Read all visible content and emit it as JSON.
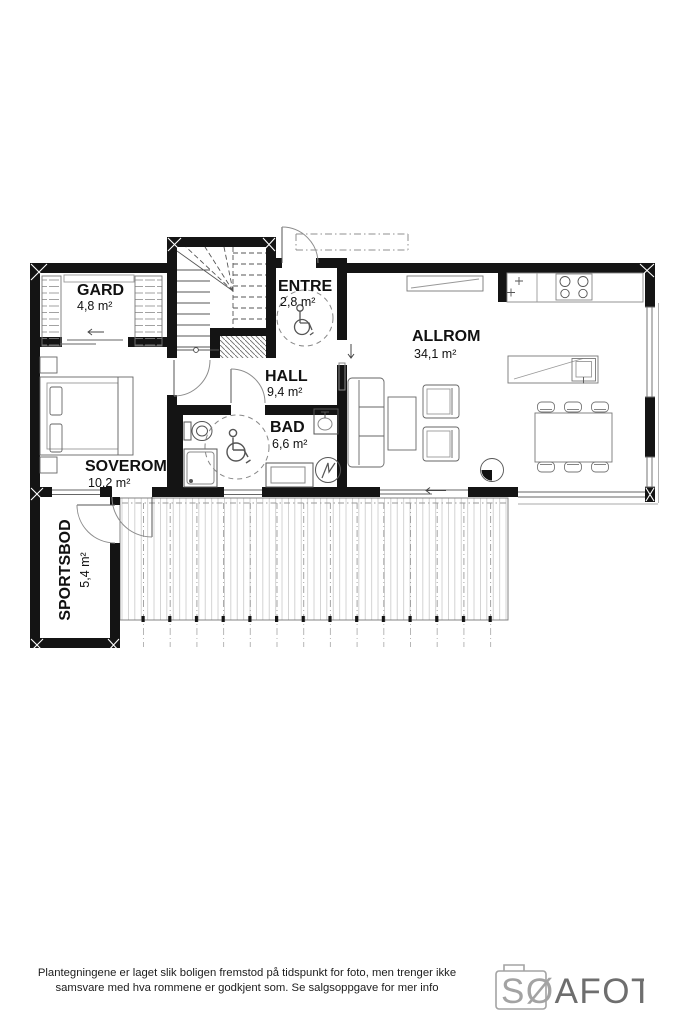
{
  "plan": {
    "title": "floor-plan-first-floor",
    "rooms": {
      "gard": {
        "name": "GARD",
        "area": "4,8 m²"
      },
      "entre": {
        "name": "ENTRE",
        "area": "2,8 m²"
      },
      "allrom": {
        "name": "ALLROM",
        "area": "34,1 m²"
      },
      "hall": {
        "name": "HALL",
        "area": "9,4 m²"
      },
      "bad": {
        "name": "BAD",
        "area": "6,6 m²"
      },
      "soverom": {
        "name": "SOVEROM",
        "area": "10,2 m²"
      },
      "sportsbod": {
        "name": "SPORTSBOD",
        "area": "5,4 m²"
      }
    },
    "icons": [
      "wheelchair-accessible-entre",
      "wheelchair-accessible-bad"
    ],
    "colors": {
      "wall": "#141414",
      "furniture_line": "#666666",
      "light_line": "#999999",
      "plank": "#c9c9c9"
    }
  },
  "footer": {
    "disclaimer_line1": "Plantegningene er laget slik boligen fremstod på tidspunkt for foto, men trenger ikke",
    "disclaimer_line2": "samsvare med hva rommene er godkjent som. Se salgsoppgave for mer info",
    "logo_prefix": "SØ",
    "logo_suffix": "AFOTO"
  }
}
